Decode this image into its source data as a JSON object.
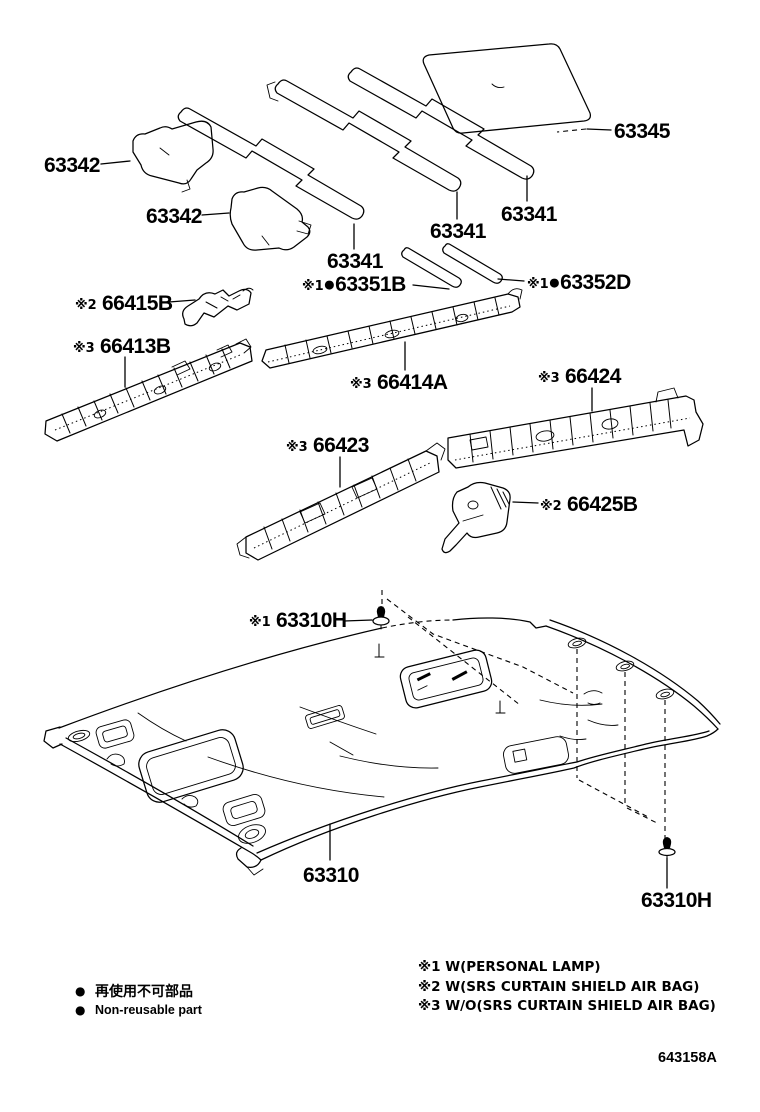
{
  "page": {
    "background": "#ffffff",
    "line_color": "#000000"
  },
  "parts": {
    "p63345": {
      "number": "63345"
    },
    "p63342_front": {
      "number": "63342"
    },
    "p63342_rear": {
      "number": "63342"
    },
    "p63341_left": {
      "number": "63341"
    },
    "p63341_center": {
      "number": "63341"
    },
    "p63341_right": {
      "number": "63341"
    },
    "p63351B": {
      "prefix": "※1",
      "number": "●63351B"
    },
    "p63352D": {
      "prefix": "※1",
      "number": "●63352D"
    },
    "p66415B": {
      "prefix": "※2",
      "number": "66415B"
    },
    "p66413B": {
      "prefix": "※3",
      "number": "66413B"
    },
    "p66414A": {
      "prefix": "※3",
      "number": "66414A"
    },
    "p66424": {
      "prefix": "※3",
      "number": "66424"
    },
    "p66423": {
      "prefix": "※3",
      "number": "66423"
    },
    "p66425B": {
      "prefix": "※2",
      "number": "66425B"
    },
    "p63310H_top": {
      "prefix": "※1",
      "number": "63310H"
    },
    "p63310": {
      "number": "63310"
    },
    "p63310H_bottom": {
      "number": "63310H"
    }
  },
  "legend": {
    "bullet": "●",
    "jp": "再使用不可部品",
    "en": "Non-reusable part"
  },
  "notes": [
    "※1 W(PERSONAL LAMP)",
    "※2 W(SRS  CURTAIN SHIELD AIR BAG)",
    "※3 W/O(SRS CURTAIN SHIELD AIR BAG)"
  ],
  "footer": {
    "drawing_number": "643158A"
  }
}
